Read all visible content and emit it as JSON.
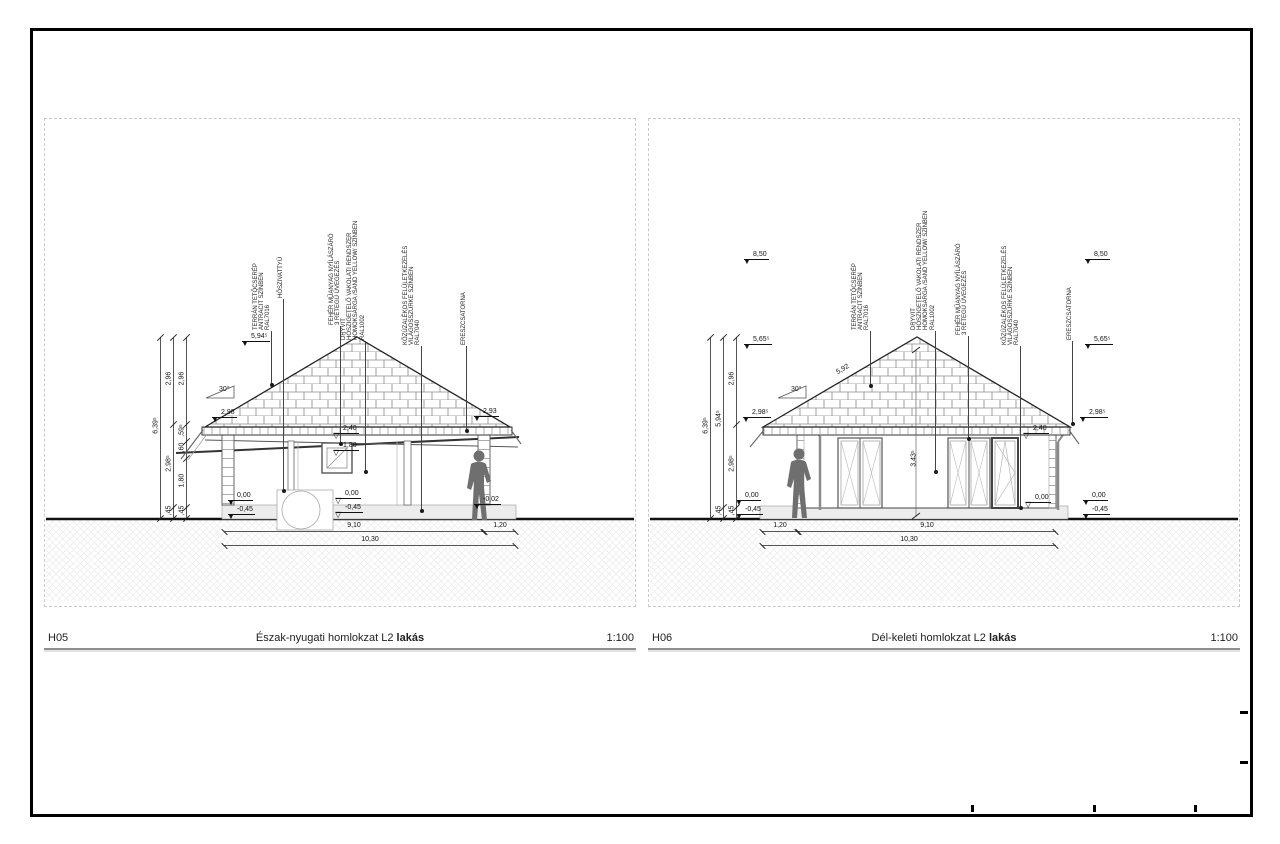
{
  "panels": [
    {
      "code": "H05",
      "title": "Észak-nyugati homlokzat L2",
      "title_suffix": "lakás",
      "scale": "1:100",
      "pitch": "30°",
      "callouts": [
        {
          "text": "TERRÁN TETŐCSERÉP\nANTRACIT SZÍNBEN\nRAL7016"
        },
        {
          "text": "HŐSZIVATTYÚ"
        },
        {
          "text": "FEHÉR MŰANYAG NYÍLÁSZÁRÓ\n3 RÉTEGŰ ÜVEGEZÉS"
        },
        {
          "text": "DRYVIT\nHŐSZIGETELŐ VAKOLATI RENDSZER\nHOMOKSÁRGA /SAND YELLOW/ SZÍNBEN\nRAL1002"
        },
        {
          "text": "KŐZÚZALÉKOS FELÜLETKEZELÉS\nVILÁGOSSZÜRKE SZÍNBEN\nRAL7040"
        },
        {
          "text": "ERESZCSATORNA"
        }
      ],
      "levels": [
        "5,94⁵",
        "2,98",
        "2,93",
        "2,40",
        "1,80",
        "0,00",
        "-0,45",
        "0,00",
        "-0,45",
        "-0,02"
      ],
      "chain_nums": [
        "6,39⁵",
        "2,96",
        "2,98⁵",
        ",45",
        "2,96",
        ",59⁵",
        ",60",
        "1,80",
        ",45"
      ],
      "hdims": [
        "9,10",
        "1,20",
        "10,30"
      ]
    },
    {
      "code": "H06",
      "title": "Dél-keleti homlokzat L2",
      "title_suffix": "lakás",
      "scale": "1:100",
      "pitch": "30°",
      "slope_dim": "5,92",
      "wall_height_dim": "3,43⁵",
      "callouts": [
        {
          "text": "TERRÁN TETŐCSERÉP\nANTRACIT SZÍNBEN\nRAL7016"
        },
        {
          "text": "DRYVIT\nHŐSZIGETELŐ VAKOLATI RENDSZER\nHOMOKSÁRGA /SAND YELLOW/ SZÍNBEN\nRAL1002"
        },
        {
          "text": "FEHÉR MŰANYAG NYÍLÁSZÁRÓ\n3 RÉTEGŰ ÜVEGEZÉS"
        },
        {
          "text": "KŐZÚZALÉKOS FELÜLETKEZELÉS\nVILÁGOSSZÜRKE SZÍNBEN\nRAL7040"
        },
        {
          "text": "ERESZCSATORNA"
        }
      ],
      "levels_left": [
        "8,50",
        "5,65⁵",
        "2,98⁵",
        "0,00",
        "-0,45"
      ],
      "levels_right": [
        "8,50",
        "5,65⁵",
        "2,98⁵",
        "0,00",
        "-0,45"
      ],
      "levels_mid": [
        "2,40",
        "0,00"
      ],
      "chain_nums": [
        "6,39⁵",
        "5,94⁵",
        ",45",
        "2,96",
        "2,98⁵",
        ",45"
      ],
      "hdims": [
        "1,20",
        "9,10",
        "10,30"
      ]
    }
  ]
}
